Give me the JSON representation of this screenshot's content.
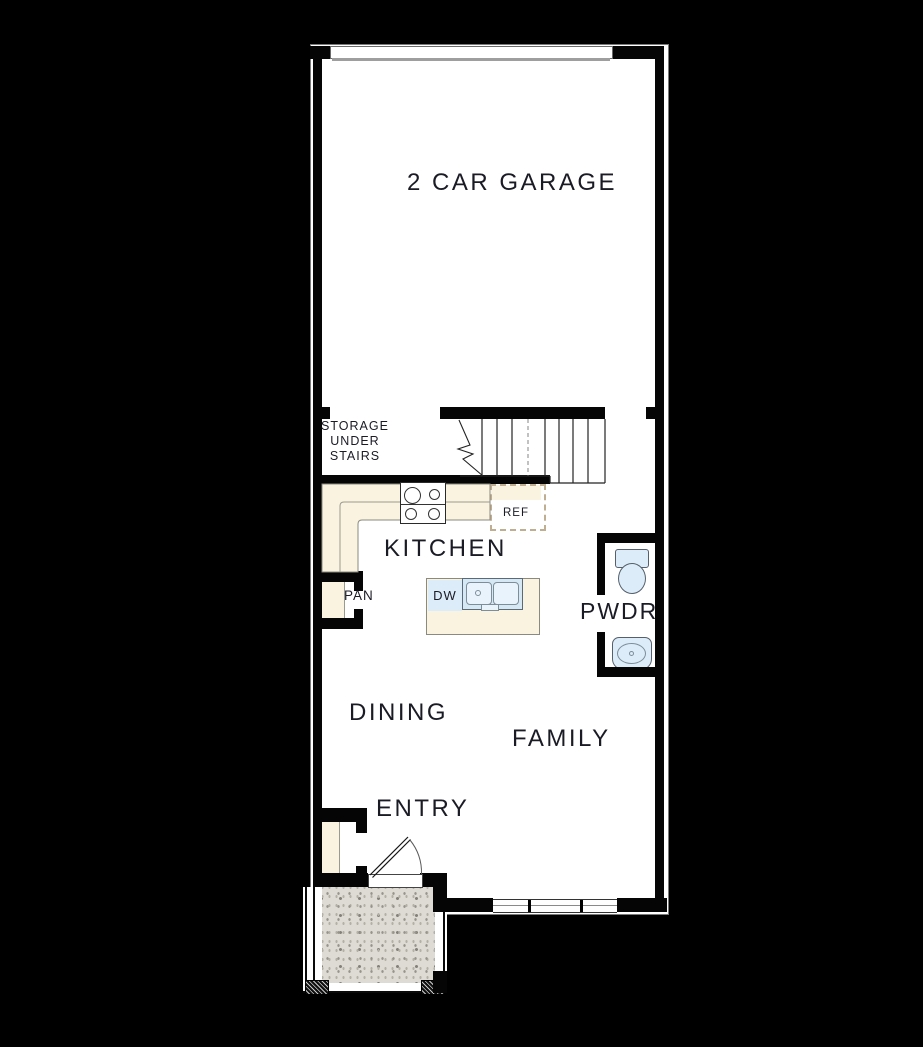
{
  "plan": {
    "title": "First floor plan",
    "rooms": {
      "garage": "2 CAR GARAGE",
      "storage": [
        "STORAGE",
        "UNDER",
        "STAIRS"
      ],
      "kitchen": "KITCHEN",
      "pantry": "PAN",
      "powder": "PWDR",
      "dining": "DINING",
      "family": "FAMILY",
      "entry": "ENTRY"
    },
    "fixtures": {
      "refrigerator": "REF",
      "dishwasher": "DW"
    },
    "colors": {
      "background": "#000000",
      "floor": "#ffffff",
      "wall": "#050505",
      "counter_beige": "#faf3e0",
      "fixture_blue": "#dcecf8",
      "porch_concrete": "#dedbd4",
      "ref_dash": "#bfae92",
      "label_text": "#1b1b26"
    }
  }
}
